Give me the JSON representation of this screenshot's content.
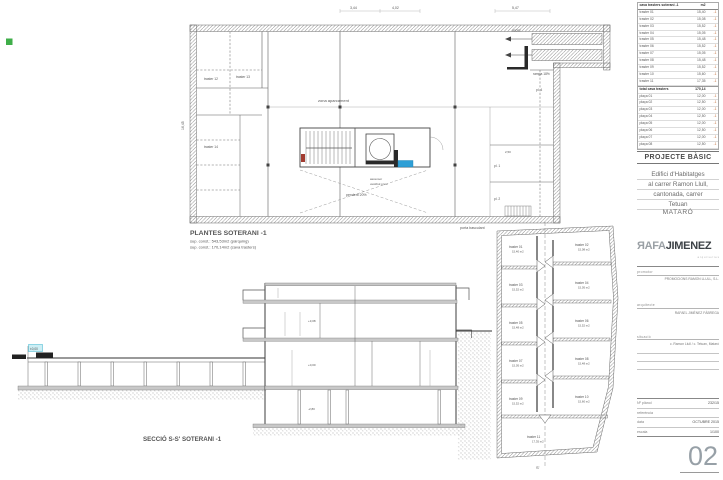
{
  "sheet": {
    "number": "02",
    "title_block": {
      "project_type": "PROJECTE BÀSIC",
      "address_lines": [
        "Edifici d'Habitatges",
        "al carrer Ramon Llull,",
        "cantonada, carrer",
        "Tetuan"
      ],
      "city": "MATARÓ",
      "logo": {
        "first": "ЯAFA",
        "second": "JIMENEZ",
        "tagline": "a r q u i t e c t e s"
      },
      "fields": [
        {
          "label": "promotor",
          "value": "PROMOCIONS RAMON LLULL, S.L."
        },
        {
          "label": "arquitecte",
          "value": "RAFAEL JIMÉNEZ FÀBREGA"
        },
        {
          "label": "situació",
          "value": "c. Ramon Llull / c. Tetuan, Mataró"
        }
      ],
      "meta": [
        {
          "label": "Nº plànol",
          "value": "232/15"
        },
        {
          "label": "referència",
          "value": ""
        },
        {
          "label": "data",
          "value": "OCTUBRE 2015"
        },
        {
          "label": "escala",
          "value": "1/100"
        }
      ],
      "schedule": {
        "rows": [
          {
            "n": "cava trasters  soterani -1",
            "a": "m2",
            "t": "",
            "cls": "head"
          },
          {
            "n": "traster 01",
            "a": "15,40",
            "t": "-1"
          },
          {
            "n": "traster 02",
            "a": "15,08",
            "t": "-1"
          },
          {
            "n": "traster 03",
            "a": "15,52",
            "t": "-1"
          },
          {
            "n": "traster 04",
            "a": "15,05",
            "t": "-1"
          },
          {
            "n": "traster 05",
            "a": "15,48",
            "t": "-1"
          },
          {
            "n": "traster 06",
            "a": "15,52",
            "t": "-1"
          },
          {
            "n": "traster 07",
            "a": "15,05",
            "t": "-1"
          },
          {
            "n": "traster 08",
            "a": "15,48",
            "t": "-1"
          },
          {
            "n": "traster 09",
            "a": "15,52",
            "t": "-1"
          },
          {
            "n": "traster 10",
            "a": "15,60",
            "t": "-1"
          },
          {
            "n": "traster 11",
            "a": "17,35",
            "t": "-1"
          },
          {
            "n": "total cava trasters",
            "a": "170,14",
            "t": "",
            "cls": "total"
          },
          {
            "n": "plaça 01",
            "a": "12,00",
            "t": "-1"
          },
          {
            "n": "plaça 02",
            "a": "12,50",
            "t": "-1"
          },
          {
            "n": "plaça 03",
            "a": "12,00",
            "t": "-1"
          },
          {
            "n": "plaça 04",
            "a": "12,50",
            "t": "-1"
          },
          {
            "n": "plaça 05",
            "a": "12,00",
            "t": "-1"
          },
          {
            "n": "plaça 06",
            "a": "12,50",
            "t": "-1"
          },
          {
            "n": "plaça 07",
            "a": "12,00",
            "t": "-1"
          },
          {
            "n": "plaça 08",
            "a": "12,50",
            "t": "-1"
          },
          {
            "n": "plaça 09",
            "a": "12,35",
            "t": "-1"
          },
          {
            "n": "total pàrquing",
            "a": "543,53",
            "t": "",
            "cls": "total"
          },
          {
            "n": "TOTAL CONSTRUÏT",
            "a": "713,67",
            "t": "",
            "cls": "grand"
          }
        ]
      }
    }
  },
  "plan": {
    "title": "PLANTES SOTERANI -1",
    "area_line1": "sup. const.: 543,53m2 (pàrquing)",
    "area_line2": "sup. const.: 170,14m2 (cava trasters)",
    "dims": {
      "d1": "3,44",
      "d2": "4,02",
      "d3": "5,47",
      "v1": "16,45",
      "d4": "2,50"
    },
    "notes": {
      "t12": "traster 12",
      "t13": "traster 13",
      "t14": "traster 14",
      "access": "accés",
      "ramp2": "rampa 18%",
      "p1": "pl. 1",
      "p2": "pl. 2",
      "p4": "pl. 4",
      "gate": "porta basculant",
      "zone": "zona aparcament",
      "ramp": "pendent 20%",
      "lift": "ascensor",
      "lobby": "vestíbul previ"
    }
  },
  "section": {
    "title": "SECCIÓ S-S'  SOTERANI -1",
    "level_marker": "±0,00",
    "levels": [
      "+3,08",
      "+0,00",
      "-2,80"
    ]
  },
  "right_plan": {
    "rooms_left": [
      {
        "name": "traster 01",
        "area": "15,40 m2"
      },
      {
        "name": "traster 03",
        "area": "15,52 m2"
      },
      {
        "name": "traster 05",
        "area": "15,48 m2"
      },
      {
        "name": "traster 07",
        "area": "15,05 m2"
      },
      {
        "name": "traster 09",
        "area": "15,52 m2"
      }
    ],
    "rooms_right": [
      {
        "name": "traster 02",
        "area": "15,08 m2"
      },
      {
        "name": "traster 04",
        "area": "15,05 m2"
      },
      {
        "name": "traster 06",
        "area": "15,52 m2"
      },
      {
        "name": "traster 08",
        "area": "15,48 m2"
      },
      {
        "name": "traster 10",
        "area": "15,60 m2"
      }
    ],
    "room_bottom": {
      "name": "traster 11",
      "area": "17,35 m2"
    },
    "marker_end": "S'"
  }
}
